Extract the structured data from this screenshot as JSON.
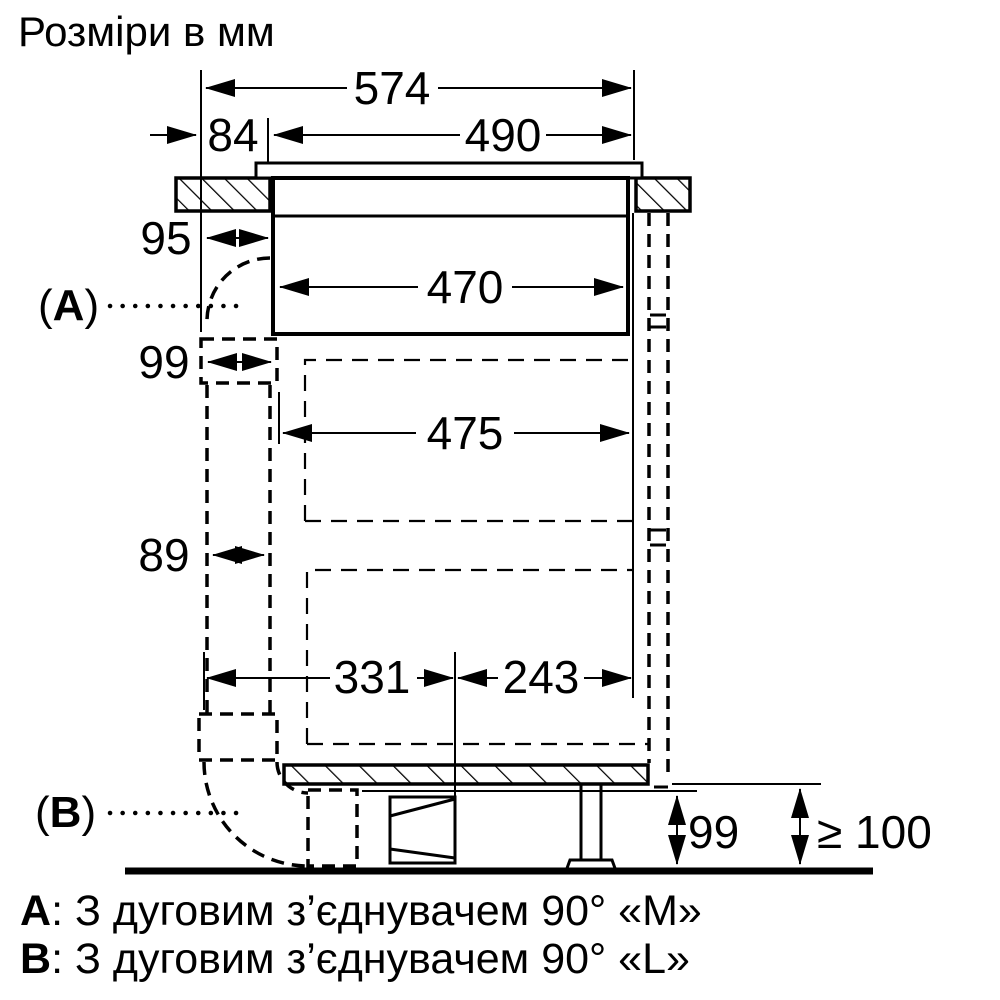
{
  "title": "Розміри в мм",
  "dims": {
    "d574": "574",
    "d84": "84",
    "d490": "490",
    "d95": "95",
    "d470": "470",
    "d99_top": "99",
    "d475": "475",
    "d89": "89",
    "d331": "331",
    "d243": "243",
    "d99_bottom": "99",
    "d100": "≥ 100"
  },
  "callouts": {
    "a": {
      "open": "(",
      "letter": "A",
      "close": ")"
    },
    "b": {
      "open": "(",
      "letter": "B",
      "close": ")"
    }
  },
  "notes": [
    {
      "key": "A",
      "text": ": З дуговим з’єднувачем 90° «M»"
    },
    {
      "key": "B",
      "text": ": З дуговим з’єднувачем 90° «L»"
    }
  ],
  "colors": {
    "ink": "#000000",
    "paper": "#ffffff"
  }
}
